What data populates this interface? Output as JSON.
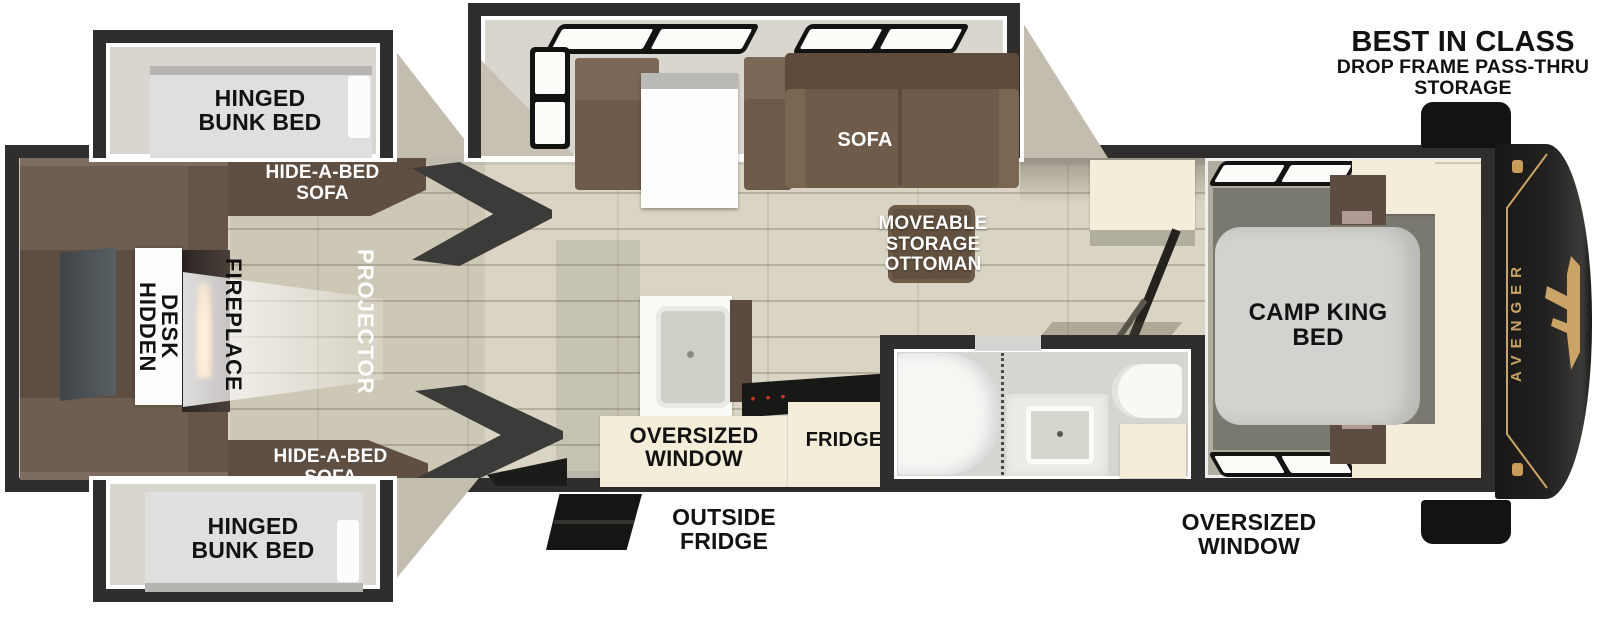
{
  "colors": {
    "wall_dark": "#2f2e2c",
    "floor_plank": "#d9d4c3",
    "slide_interior": "#d8d6ce",
    "cabinet_brown": "#6e5d51",
    "sofa_brown": "#6f5b49",
    "hide_a_bed_brown": "#5f4e42",
    "cream": "#f3edda",
    "accent_gold": "#c9a466",
    "cap_black": "#181715",
    "mattress_gray": "#d3d2ce",
    "label_dark": "#121212",
    "label_light": "#ffffff",
    "projector_beam": "rgba(255,255,255,0.6)"
  },
  "labels": {
    "best1": "BEST IN CLASS",
    "best2": "DROP FRAME PASS-THRU",
    "best3": "STORAGE",
    "bunk_top": "HINGED\nBUNK BED",
    "bunk_bottom": "HINGED\nBUNK BED",
    "hide_top": "HIDE-A-BED\nSOFA",
    "hide_bottom": "HIDE-A-BED\nSOFA",
    "hidden_desk": "HIDDEN\nDESK",
    "fireplace": "FIREPLACE",
    "projector": "PROJECTOR",
    "sofa": "SOFA",
    "ottoman": "MOVEABLE\nSTORAGE\nOTTOMAN",
    "camp_king": "CAMP KING\nBED",
    "ow_kitchen": "OVERSIZED\nWINDOW",
    "fridge": "FRIDGE",
    "outside_fridge": "OUTSIDE\nFRIDGE",
    "ow_bedroom": "OVERSIZED\nWINDOW",
    "brand": "AVENGER"
  }
}
